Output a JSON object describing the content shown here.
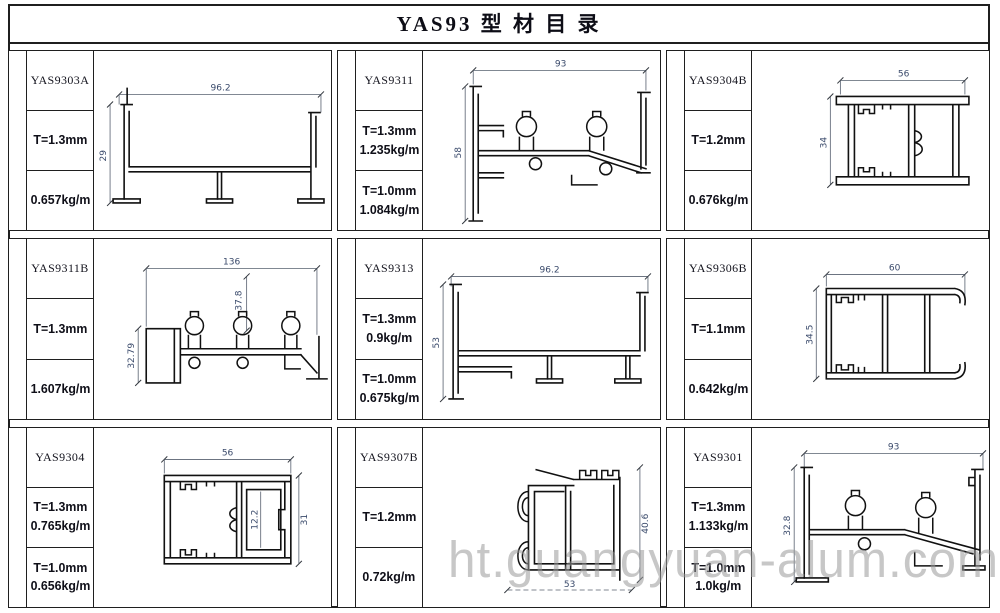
{
  "title": "YAS93 型 材 目 录",
  "watermark": "ht.guangyuan-alum.com",
  "colors": {
    "background": "#ffffff",
    "border": "#1f1f1f",
    "profile_line": "#111111",
    "dim_text": "#3a4a6b",
    "watermark": "#9a9a9a"
  },
  "cells": [
    {
      "code": "YAS9303A",
      "box2": [
        "T=1.3mm"
      ],
      "box3": [
        "0.657kg/m"
      ],
      "dims": {
        "w": "96.2",
        "h": "29"
      }
    },
    {
      "code": "YAS9311",
      "box2": [
        "T=1.3mm",
        "1.235kg/m"
      ],
      "box3": [
        "T=1.0mm",
        "1.084kg/m"
      ],
      "dims": {
        "w": "93",
        "h": "58"
      }
    },
    {
      "code": "YAS9304B",
      "box2": [
        "T=1.2mm"
      ],
      "box3": [
        "0.676kg/m"
      ],
      "dims": {
        "w": "56",
        "h": "34"
      }
    },
    {
      "code": "YAS9311B",
      "box2": [
        "T=1.3mm"
      ],
      "box3": [
        "1.607kg/m"
      ],
      "dims": {
        "w": "136",
        "h": "32.79",
        "h2": "37.8"
      }
    },
    {
      "code": "YAS9313",
      "box2": [
        "T=1.3mm",
        "0.9kg/m"
      ],
      "box3": [
        "T=1.0mm",
        "0.675kg/m"
      ],
      "dims": {
        "w": "96.2",
        "h": "53"
      }
    },
    {
      "code": "YAS9306B",
      "box2": [
        "T=1.1mm"
      ],
      "box3": [
        "0.642kg/m"
      ],
      "dims": {
        "w": "60",
        "h": "34.5"
      }
    },
    {
      "code": "YAS9304",
      "box2": [
        "T=1.3mm",
        "0.765kg/m"
      ],
      "box3": [
        "T=1.0mm",
        "0.656kg/m"
      ],
      "dims": {
        "w": "56",
        "h": "31",
        "h2": "12.2"
      }
    },
    {
      "code": "YAS9307B",
      "box2": [
        "T=1.2mm"
      ],
      "box3": [
        "0.72kg/m"
      ],
      "dims": {
        "w": "53",
        "h": "40.6"
      }
    },
    {
      "code": "YAS9301",
      "box2": [
        "T=1.3mm",
        "1.133kg/m"
      ],
      "box3": [
        "T=1.0mm",
        "1.0kg/m"
      ],
      "dims": {
        "w": "93",
        "h": "32.8"
      }
    }
  ]
}
